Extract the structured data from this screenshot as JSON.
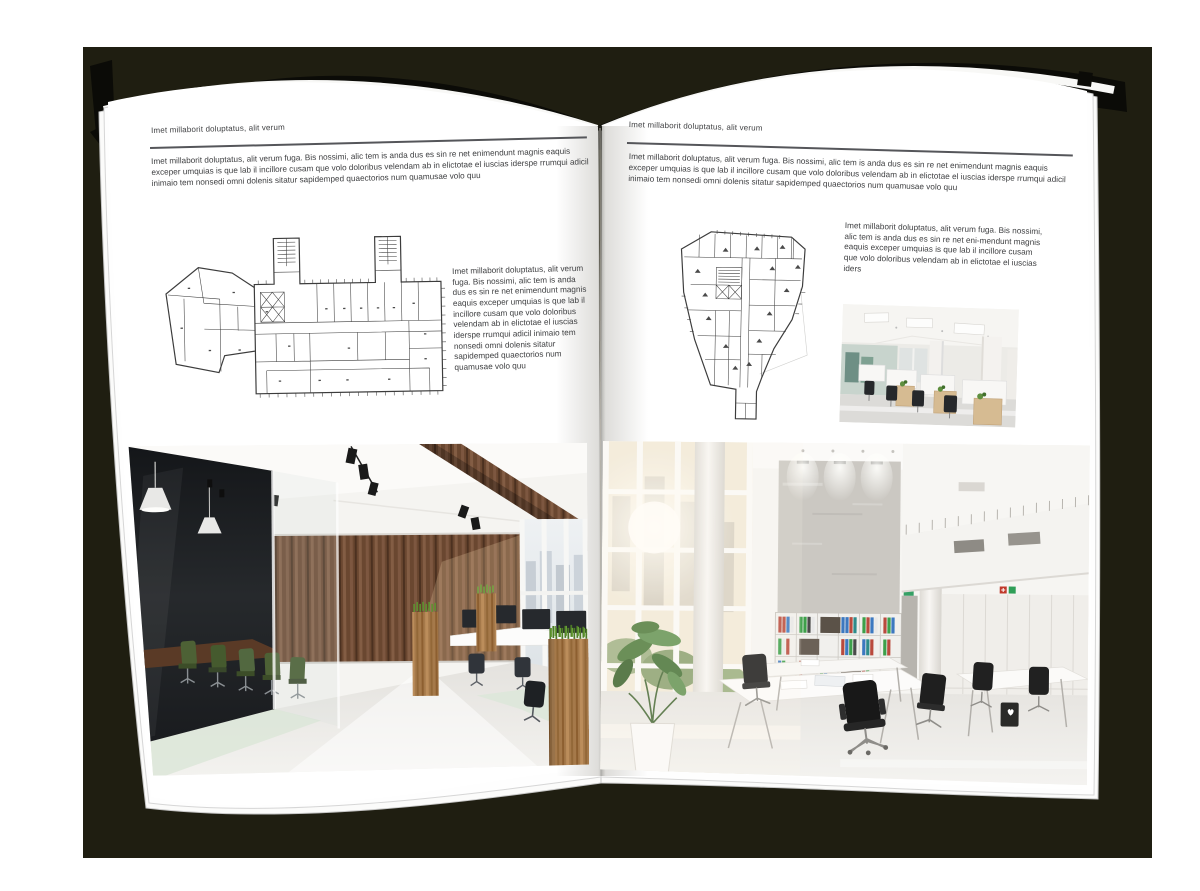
{
  "scene": {
    "canvas_color": "#ffffff",
    "backdrop_color": "#1f1e11",
    "cover_color": "#0b0b07",
    "page_color": "#ffffff",
    "text_color": "#3e3f41",
    "rule_color": "#55565a"
  },
  "left_page": {
    "header": "Imet millaborit doluptatus, alit verum",
    "intro": "Imet millaborit doluptatus, alit verum fuga. Bis nossimi, alic tem is anda dus es sin re net enimendunt magnis eaquis exceper umquias is que lab il incillore cusam que volo doloribus velendam ab in elictotae el iuscias iderspe rrumqui adicil inimaio tem nonsedi omni dolenis sitatur sapidemped quaectorios num quamusae volo quu",
    "side_text": "Imet millaborit doluptatus, alit verum fuga. Bis nossimi, alic tem is anda dus es sin re net enimendunt magnis eaquis exceper umquias is que lab il incillore cusam que volo doloribus velendam ab in elictotae el iuscias iderspe rrumqui adicil inimaio tem nonsedi omni dolenis sitatur sapidemped quaectorios num quamusae volo quu",
    "floorplan_label": "floor-plan-elongated-building-with-stair-towers",
    "photo_label": "office-interior-dark-glass-meeting-room-wood-wall"
  },
  "right_page": {
    "header": "Imet millaborit doluptatus, alit verum",
    "intro": "Imet millaborit doluptatus, alit verum fuga. Bis nossimi, alic tem is anda dus es sin re net enimendunt magnis eaquis exceper umquias is que lab il incillore cusam que volo doloribus velendam ab in elictotae el iuscias iderspe rrumqui adicil inimaio tem nonsedi omni dolenis sitatur sapidemped quaectorios num quamusae volo quu",
    "side_text": "Imet millaborit doluptatus, alit verum fuga. Bis nossimi, alic tem is anda dus es sin re net eni-mendunt magnis eaquis exceper umquias is que lab il incillore cusam que volo doloribus velendam ab in elictotae el iuscias iders",
    "floorplan_label": "floor-plan-irregular-building-with-stem",
    "photo_small_label": "office-interior-open-plan-wood-cabinets",
    "photo_label": "office-interior-double-height-atrium"
  },
  "palette": {
    "wood_dark": "#6f4b33",
    "wood_oak": "#a5794a",
    "plant_green": "#5e9130",
    "chair_green": "#4d6135",
    "binder_red": "#b94a3d",
    "binder_blue": "#3c78c0",
    "binder_green": "#3da04a"
  }
}
